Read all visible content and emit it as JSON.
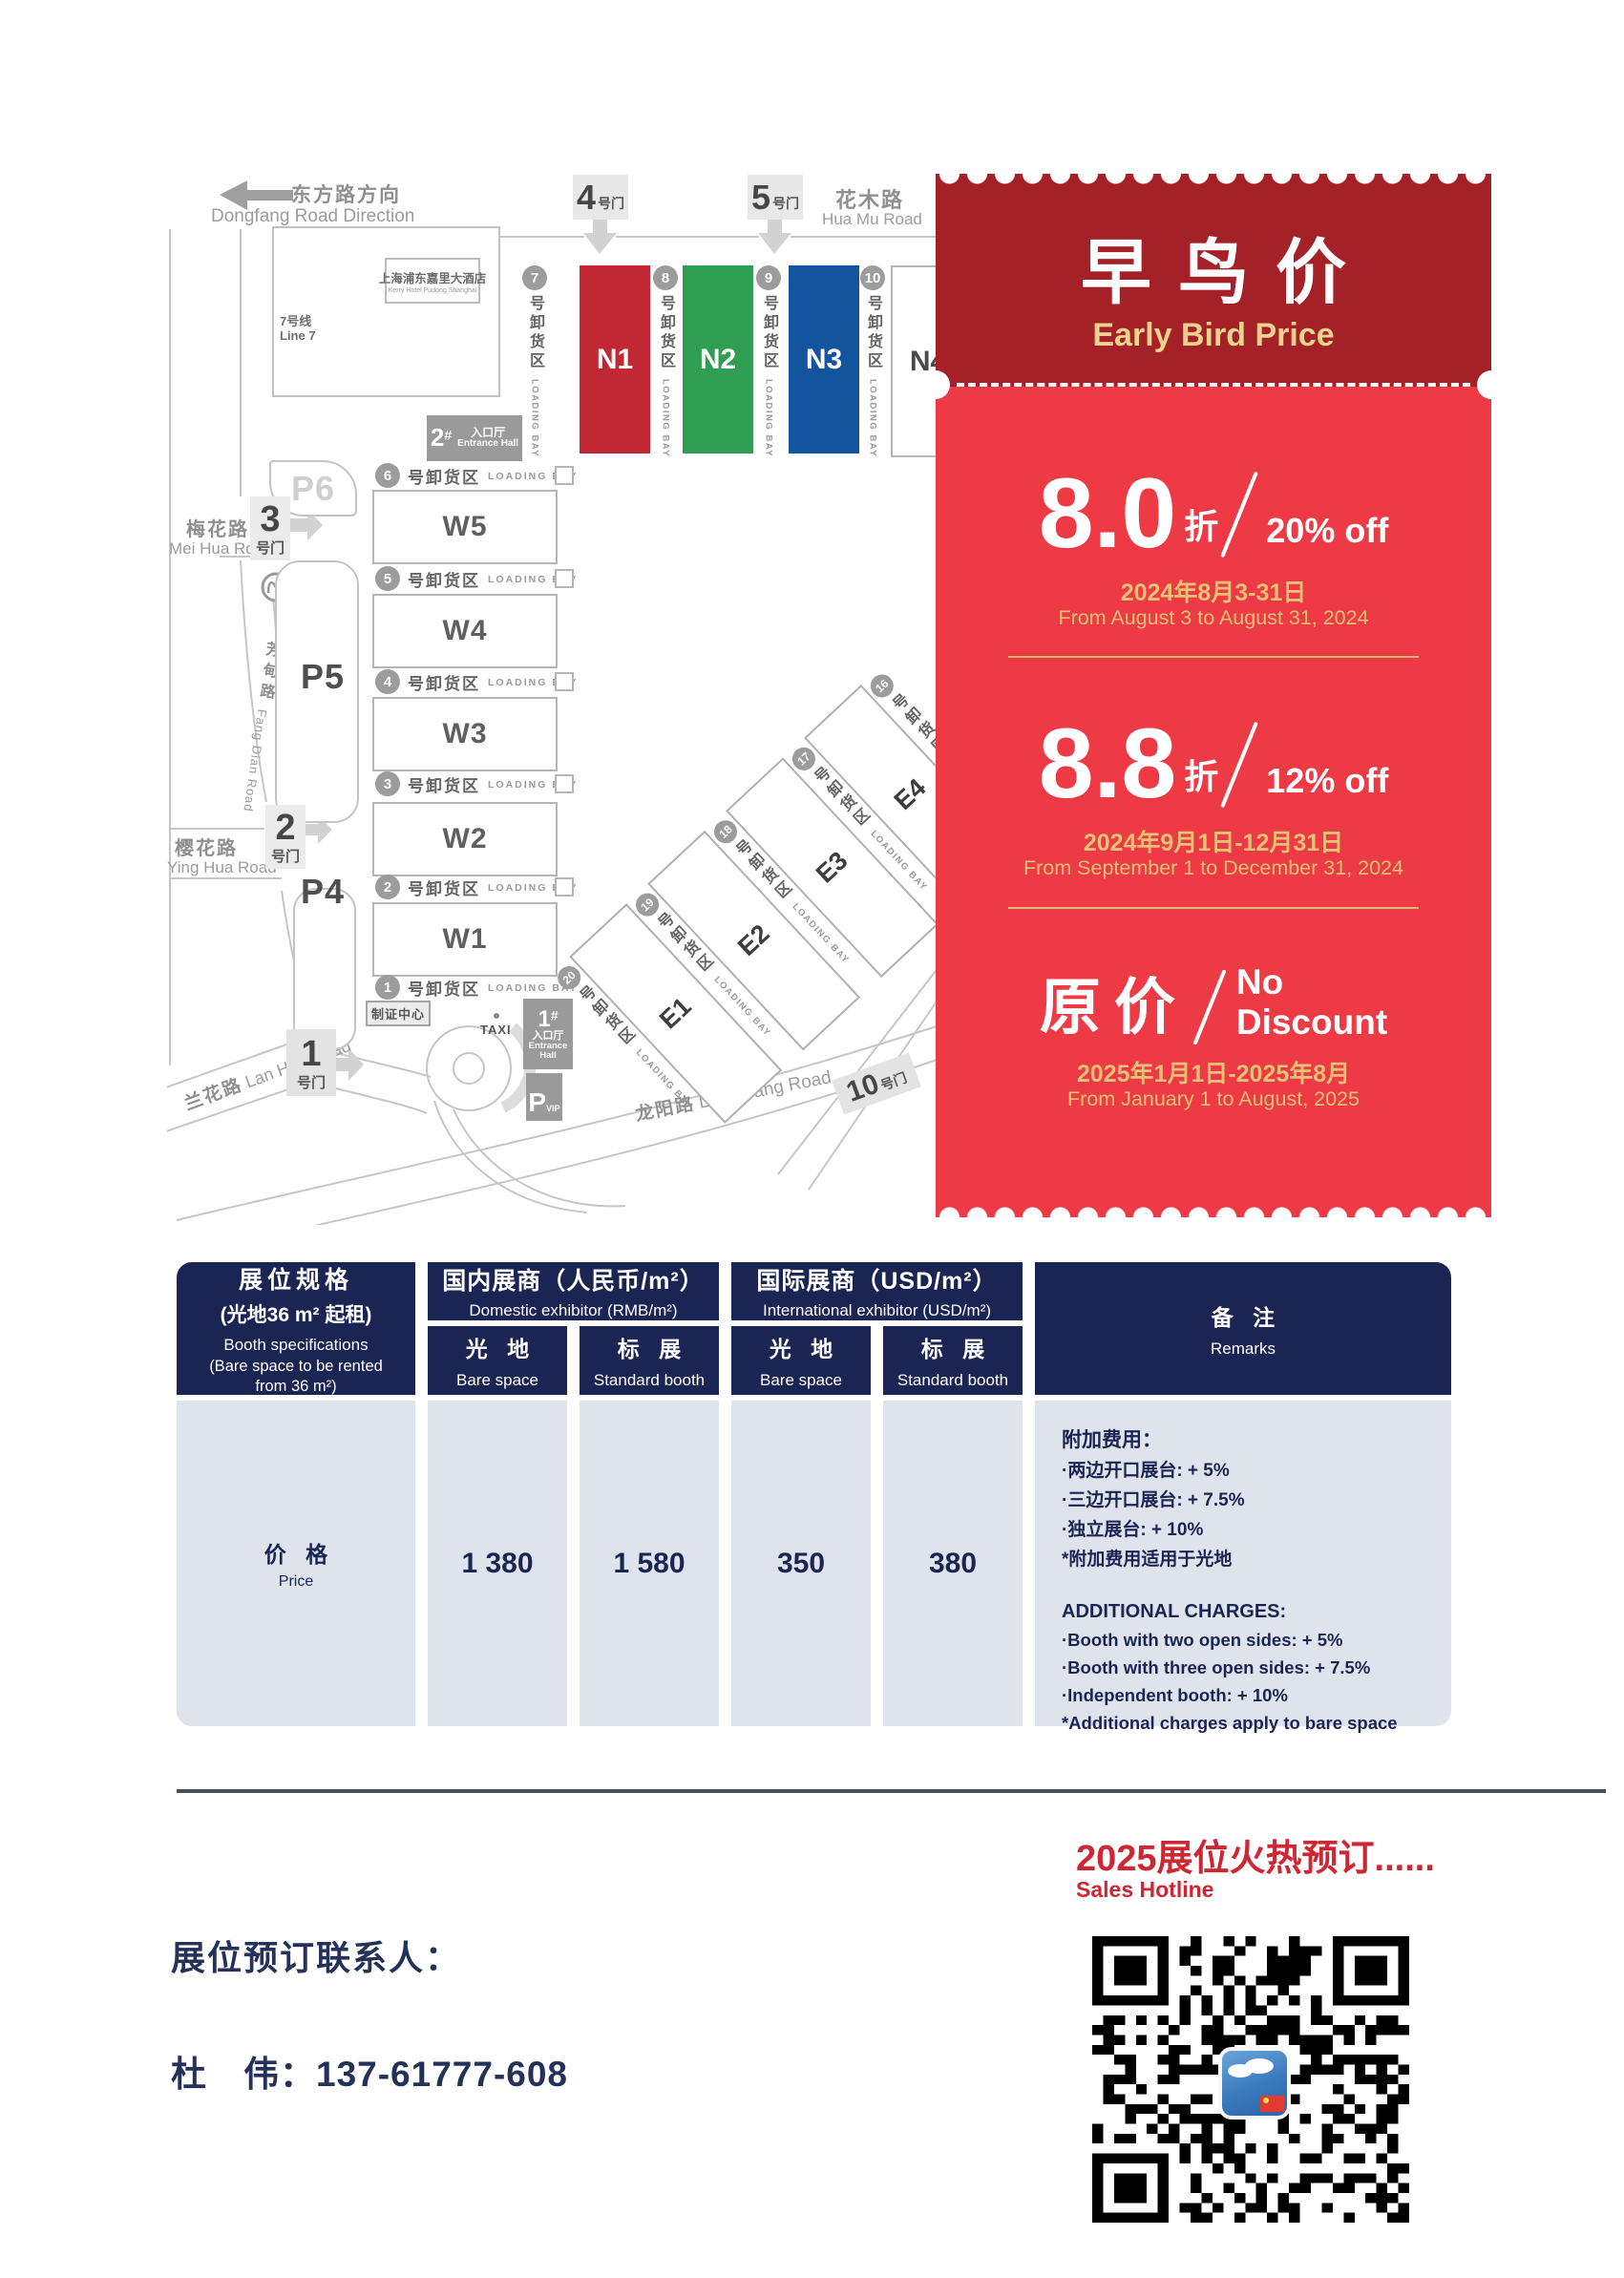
{
  "map": {
    "dongfang_cn": "东方路方向",
    "dongfang_en": "Dongfang Road Direction",
    "huamu_cn": "花木路",
    "huamu_en": "Hua Mu Road",
    "meihua_cn": "梅花路",
    "meihua_en": "Mei Hua Road",
    "yinghua_cn": "樱花路",
    "yinghua_en": "Ying Hua Road",
    "lanhua_cn": "兰花路",
    "lanhua_en": "Lan Hua Road",
    "fangdian_cn": "芳甸路",
    "fangdian_en": "Fang Dian Road",
    "longyang_cn": "龙阳路",
    "longyang_en": "Long Yang Road",
    "hotel_cn": "上海浦东嘉里大酒店",
    "hotel_en": "Kerry Hotel Pudong Shanghai",
    "line7_cn": "7号线",
    "line7_en": "Line 7",
    "badge_center": "制证中心",
    "taxi": "TAXI",
    "gate_suffix": "号门",
    "gates": {
      "g1": "1",
      "g2": "2",
      "g3": "3",
      "g4": "4",
      "g5": "5",
      "g10": "10"
    },
    "entrance1_no": "1",
    "entrance2_no": "2",
    "entrance_hash": "#",
    "entrance_cn": "入口厅",
    "entrance_en": "Entrance Hall",
    "p4": "P4",
    "p5": "P5",
    "p6": "P6",
    "vip_p": "P",
    "vip": "VIP",
    "halls_n": [
      "N1",
      "N2",
      "N3",
      "N4"
    ],
    "halls_w": [
      "W5",
      "W4",
      "W3",
      "W2",
      "W1"
    ],
    "halls_e": [
      "E1",
      "E2",
      "E3",
      "E4"
    ],
    "bay_cn": "号卸货区",
    "bay_en": "LOADING BAY",
    "w_bays": [
      "6",
      "5",
      "4",
      "3",
      "2",
      "1"
    ],
    "n_bays": [
      "7",
      "8",
      "9",
      "10"
    ],
    "e_bays": [
      "20",
      "19",
      "18",
      "17",
      "16"
    ]
  },
  "coupon": {
    "title_cn": "早鸟价",
    "title_en": "Early Bird Price",
    "tier1_big": "8.0",
    "tier1_zhe": "折",
    "tier1_off": "20% off",
    "tier1_date_cn": "2024年8月3-31日",
    "tier1_date_en": "From August 3 to August 31, 2024",
    "tier2_big": "8.8",
    "tier2_zhe": "折",
    "tier2_off": "12% off",
    "tier2_date_cn": "2024年9月1日-12月31日",
    "tier2_date_en": "From September 1 to December 31, 2024",
    "tier3_big": "原价",
    "tier3_off1": "No",
    "tier3_off2": "Discount",
    "tier3_date_cn": "2025年1月1日-2025年8月",
    "tier3_date_en": "From January 1 to August, 2025"
  },
  "table": {
    "spec_l1": "展位规格",
    "spec_l2": "(光地36 m² 起租)",
    "spec_l3": "Booth specifications",
    "spec_l4": "(Bare space to be rented",
    "spec_l5": "from 36 m²)",
    "domestic_cn": "国内展商（人民币/m²）",
    "domestic_en": "Domestic exhibitor (RMB/m²)",
    "intl_cn": "国际展商（USD/m²）",
    "intl_en": "International exhibitor (USD/m²)",
    "bare_cn": "光 地",
    "bare_en": "Bare space",
    "std_cn": "标 展",
    "std_en": "Standard booth",
    "remarks_cn": "备 注",
    "remarks_en": "Remarks",
    "price_cn": "价 格",
    "price_en": "Price",
    "values": [
      "1 380",
      "1 580",
      "350",
      "380"
    ],
    "remarks_cn_lines": [
      "附加费用：",
      "·两边开口展台: + 5%",
      "·三边开口展台: + 7.5%",
      "·独立展台: + 10%",
      "*附加费用适用于光地"
    ],
    "remarks_en_lines": [
      "ADDITIONAL CHARGES:",
      "·Booth with two open sides: + 5%",
      "·Booth with three open sides: + 7.5%",
      "·Independent booth: + 10%",
      "*Additional charges apply to bare space"
    ]
  },
  "footer": {
    "hot_cn": "2025展位火热预订......",
    "hot_en": "Sales Hotline",
    "contact_label": "展位预订联系人：",
    "contact_line": "杜　伟：137-61777-608"
  },
  "colors": {
    "coupon_header_red": "#a32127",
    "coupon_body_red": "#ee3a44",
    "gold": "#e6c277",
    "hall_n1_red": "#c22833",
    "hall_n2_green": "#2f9e52",
    "hall_n3_blue": "#13549e",
    "table_navy": "#1b2553",
    "table_body_gray": "#dfe3ec",
    "footer_red": "#ce2733",
    "text_navy": "#243158"
  }
}
